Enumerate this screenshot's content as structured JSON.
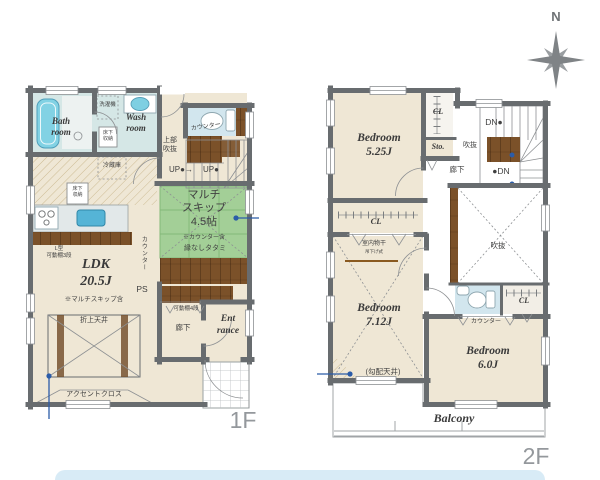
{
  "page": {
    "floor1_label": "1F",
    "floor2_label": "2F",
    "compass_n": "N"
  },
  "colors": {
    "wall": "#686c6f",
    "tatami_green": "#a3cf97",
    "wood_brown": "#7b5129",
    "water_blue": "#82d2e4",
    "callout_blue": "#2b5ca8",
    "floor_beige": "#efe7d5",
    "bottom_bar": "#d8ebf6"
  },
  "f1": {
    "bath": "Bath\nroom",
    "wash": "Wash\nroom",
    "washer": "洗濯機",
    "underfloor_a": "床下\n収納",
    "underfloor_b": "床下\n収納",
    "counter_wc": "カウンター",
    "upper_void": "上部\n吹抜",
    "up_left": "UP●→",
    "up_right": "UP●",
    "fridge": "冷蔵庫",
    "l_shelf": "L型\n可動棚3段",
    "ldk": "LDK\n20.5J",
    "ldk_note": "※マルチスキップ含",
    "coffered": "折上天井",
    "accent": "アクセントクロス",
    "counter_v": "カウンター",
    "ps": "PS",
    "multi": "マルチ\nスキップ\n4.5帖",
    "multi_a": "※カウンター含",
    "multi_b": "縁なしタタミ",
    "shelf4": "可動棚4段",
    "hall": "廊下",
    "entrance": "Ent\nrance"
  },
  "f2": {
    "bed1": "Bedroom\n5.25J",
    "cl_top": "CL",
    "sto": "Sto.",
    "dn_top": "DN●",
    "void_stair": "吹抜",
    "dn_bottom": "●DN",
    "hall": "廊下",
    "cl_mid": "CL",
    "drying": "室内物干",
    "drying_sub": "吊下げ式",
    "bed2": "Bedroom\n7.12J",
    "sloped": "(勾配天井)",
    "void_main": "吹抜",
    "cl_right": "CL",
    "counter": "カウンター",
    "bed3": "Bedroom\n6.0J",
    "balcony": "Balcony"
  }
}
